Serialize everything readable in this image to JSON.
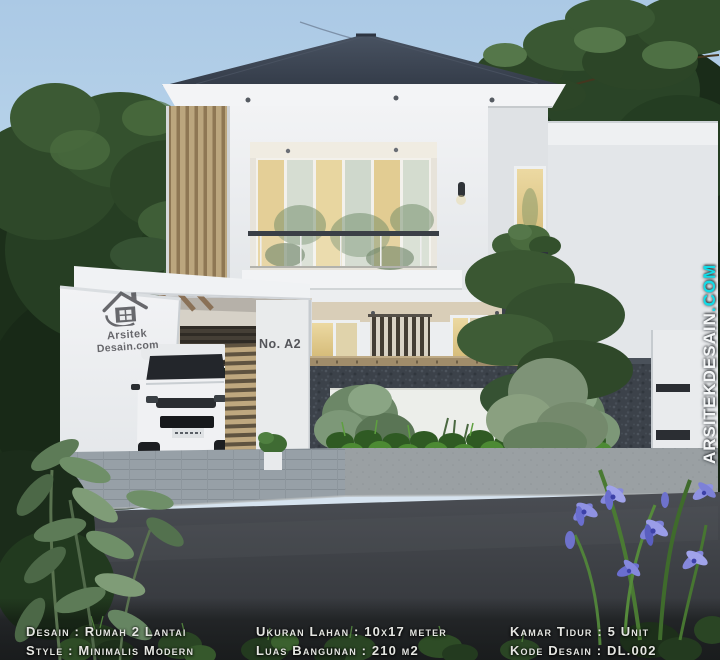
{
  "scene": {
    "description": "3D exterior render of a modern minimalist two-storey house"
  },
  "house": {
    "number_plate": "No. A2"
  },
  "watermarks": {
    "side_name": "ARSITEKDESAIN",
    "side_tld": ".COM",
    "logo_line1": "Arsitek",
    "logo_line2": "Desain.com"
  },
  "info_bar": {
    "col1": {
      "line1": "Desain : Rumah 2 Lantai",
      "line2": "Style : Minimalis Modern"
    },
    "col2": {
      "line1": "Ukuran Lahan : 10x17 meter",
      "line2": "Luas Bangunan : 210 m2"
    },
    "col3": {
      "line1": "Kamar Tidur : 5 Unit",
      "line2": "Kode Desain : DL.002"
    }
  },
  "colors": {
    "accent_cyan": "#12dbe6",
    "roof": "#3d4654",
    "sky": "#b7d2e9",
    "road": "#3f4247",
    "foliage_dark": "#1d301b",
    "wood_slat": "#b49c74",
    "carport_ceiling_teal": "#37b3b6"
  }
}
